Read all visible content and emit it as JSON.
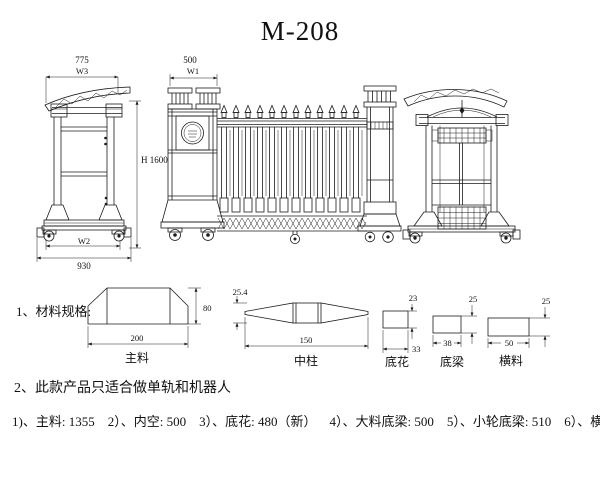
{
  "title": "M-208",
  "drawing": {
    "left_post": {
      "width": "775",
      "width_label": "W3",
      "height": "H 1600",
      "base_inner_label": "W2",
      "base_width": "930"
    },
    "head": {
      "width": "500",
      "width_label": "W1"
    }
  },
  "materials": {
    "heading": "1、材料规格:",
    "sections": [
      {
        "name": "主料",
        "w": "200",
        "h": "80"
      },
      {
        "name": "中柱",
        "w": "150",
        "h": "25.4"
      },
      {
        "name": "底花",
        "w": "33",
        "h": "23"
      },
      {
        "name": "底梁",
        "w": "38",
        "h": "25"
      },
      {
        "name": "横料",
        "w": "50",
        "h": "25"
      }
    ]
  },
  "note": "2、此款产品只适合做单轨和机器人",
  "specs": {
    "items": [
      "1)、主料: 1355",
      "2）、内空: 500",
      "3）、底花: 480（新）",
      "4）、大料底梁: 500",
      "5）、小轮底梁: 510",
      "6）、横料: 482"
    ]
  },
  "colors": {
    "line": "#1b1b1b",
    "background": "#ffffff"
  }
}
